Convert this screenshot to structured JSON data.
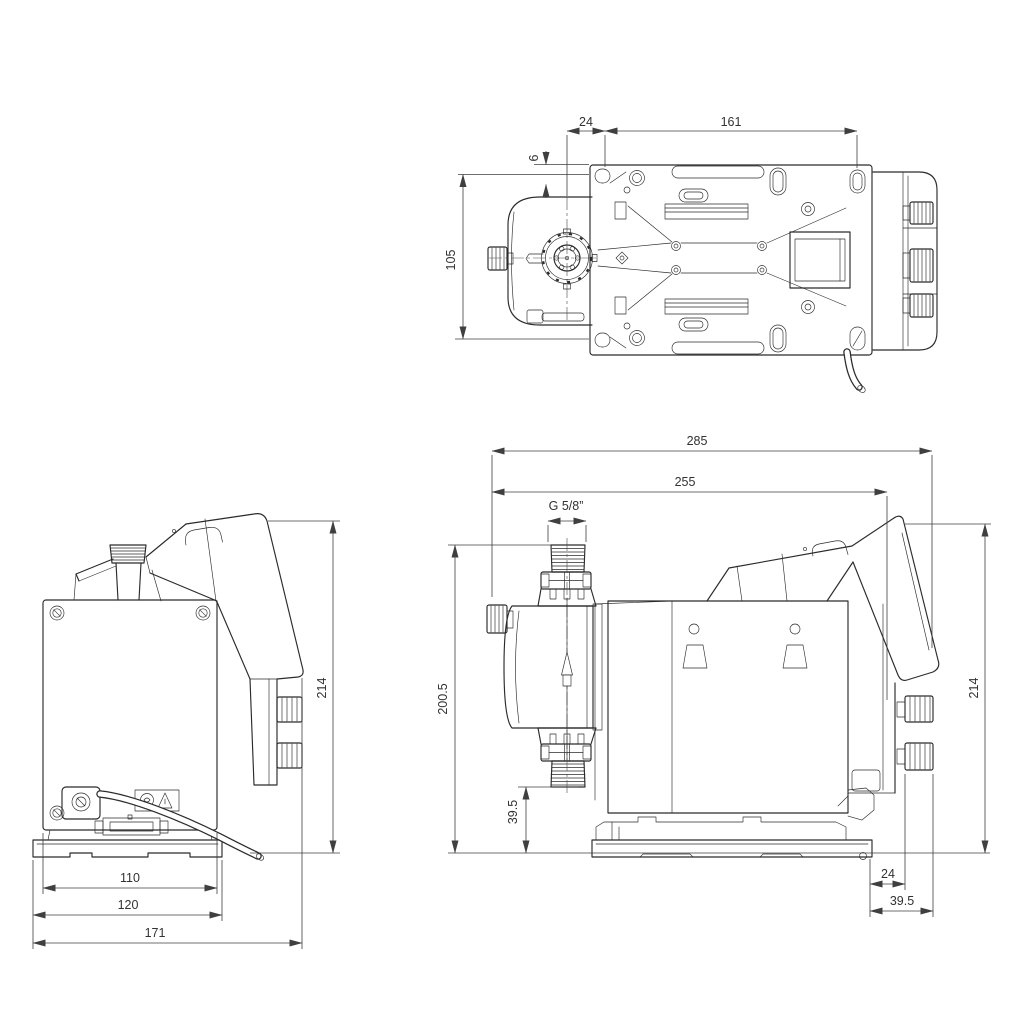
{
  "drawing": {
    "kind": "dimensional-drawing",
    "views": {
      "top": {
        "dims": {
          "flange_to_hole": "24",
          "hole_spacing": "161",
          "edge_to_hole": "6",
          "plate_height": "105"
        }
      },
      "front": {
        "dims": {
          "overall_height": "214",
          "box_width": "110",
          "base_width": "120",
          "overall_width": "171"
        }
      },
      "side": {
        "dims": {
          "overall_length": "285",
          "length_to_rear": "255",
          "thread_size": "G 5/8”",
          "height_over_connector": "200.5",
          "connector_height": "39.5",
          "overall_height": "214",
          "rear_offset": "24",
          "rear_depth": "39.5"
        }
      }
    }
  }
}
